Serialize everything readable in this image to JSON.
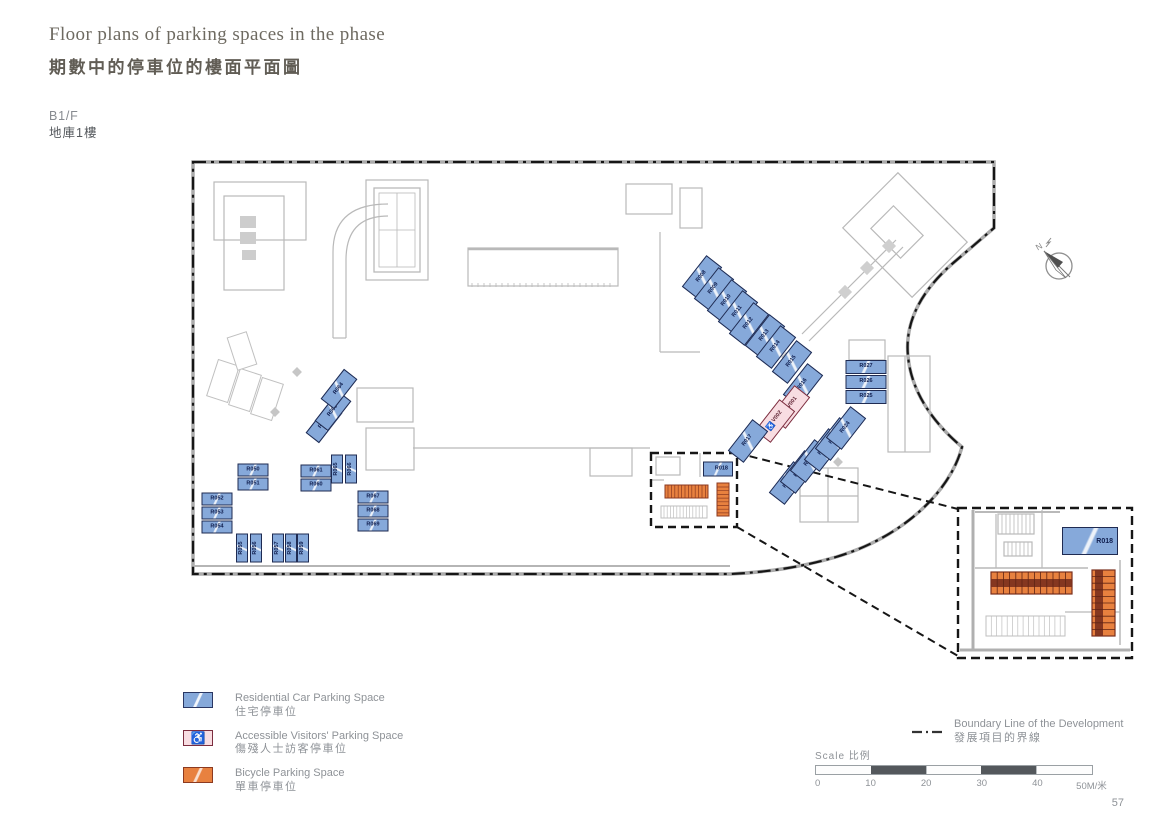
{
  "header": {
    "title_en": "Floor plans of parking spaces in the phase",
    "title_zh": "期數中的停車位的樓面平面圖",
    "floor_en": "B1/F",
    "floor_zh": "地庫1樓"
  },
  "compass": {
    "north_label": "N"
  },
  "legend": {
    "residential": {
      "label_en": "Residential Car Parking Space",
      "label_zh": "住宅停車位",
      "color": "#86a9da"
    },
    "accessible": {
      "label_en": "Accessible Visitors' Parking Space",
      "label_zh": "傷殘人士訪客停車位",
      "color": "#f8dde2",
      "icon": "wheelchair"
    },
    "bicycle": {
      "label_en": "Bicycle Parking Space",
      "label_zh": "單車停車位",
      "color": "#e8813f"
    },
    "boundary": {
      "label_en": "Boundary Line of the Development",
      "label_zh": "發展項目的界線"
    }
  },
  "scalebar": {
    "label": "Scale 比例",
    "ticks": [
      "0",
      "10",
      "20",
      "30",
      "40",
      "50M/米"
    ]
  },
  "page_number": "57",
  "colors": {
    "residential_fill": "#86a9da",
    "residential_border": "#1f2b52",
    "accessible_fill": "#f8dde2",
    "accessible_border": "#7c2d3f",
    "bicycle_fill": "#e8813f",
    "bicycle_border": "#8c3a20",
    "boundary_line": "#161616",
    "linework": "#b9b9b9"
  },
  "spaces": [
    {
      "label": "R008",
      "x": 702,
      "y": 277,
      "w": 40,
      "h": 20,
      "rot": -52
    },
    {
      "label": "R009",
      "x": 714,
      "y": 289,
      "w": 40,
      "h": 20,
      "rot": -52
    },
    {
      "label": "R010",
      "x": 727,
      "y": 301,
      "w": 40,
      "h": 20,
      "rot": -52
    },
    {
      "label": "R011",
      "x": 738,
      "y": 312,
      "w": 40,
      "h": 20,
      "rot": -52
    },
    {
      "label": "R012",
      "x": 749,
      "y": 324,
      "w": 40,
      "h": 20,
      "rot": -52
    },
    {
      "label": "R013",
      "x": 765,
      "y": 336,
      "w": 40,
      "h": 20,
      "rot": -52
    },
    {
      "label": "R014",
      "x": 776,
      "y": 347,
      "w": 40,
      "h": 20,
      "rot": -52
    },
    {
      "label": "R015",
      "x": 792,
      "y": 362,
      "w": 40,
      "h": 20,
      "rot": -52
    },
    {
      "label": "R016",
      "x": 803,
      "y": 385,
      "w": 40,
      "h": 20,
      "rot": -52
    },
    {
      "label": "V001",
      "x": 790,
      "y": 407,
      "w": 40,
      "h": 20,
      "rot": -52,
      "type": "a"
    },
    {
      "label": "V002",
      "x": 775,
      "y": 421,
      "w": 40,
      "h": 20,
      "rot": -52,
      "type": "a"
    },
    {
      "label": "R017",
      "x": 748,
      "y": 441,
      "w": 40,
      "h": 20,
      "rot": -52
    },
    {
      "label": "R019",
      "x": 789,
      "y": 483,
      "w": 40,
      "h": 20,
      "rot": -52
    },
    {
      "label": "R020",
      "x": 800,
      "y": 472,
      "w": 40,
      "h": 20,
      "rot": -52
    },
    {
      "label": "R021",
      "x": 810,
      "y": 461,
      "w": 40,
      "h": 20,
      "rot": -52
    },
    {
      "label": "R022",
      "x": 824,
      "y": 450,
      "w": 40,
      "h": 20,
      "rot": -52
    },
    {
      "label": "R023",
      "x": 835,
      "y": 439,
      "w": 40,
      "h": 20,
      "rot": -52
    },
    {
      "label": "R024",
      "x": 846,
      "y": 428,
      "w": 40,
      "h": 20,
      "rot": -52
    },
    {
      "label": "R025",
      "x": 866,
      "y": 397,
      "w": 41,
      "h": 14,
      "rot": 0
    },
    {
      "label": "R026",
      "x": 866,
      "y": 382,
      "w": 41,
      "h": 14,
      "rot": 0
    },
    {
      "label": "R027",
      "x": 866,
      "y": 367,
      "w": 41,
      "h": 14,
      "rot": 0
    },
    {
      "label": "R018",
      "x": 718,
      "y": 469,
      "w": 30,
      "h": 15,
      "rot": 0,
      "align": "right"
    },
    {
      "label": "R050",
      "x": 253,
      "y": 470,
      "w": 31,
      "h": 13,
      "rot": 0
    },
    {
      "label": "R051",
      "x": 253,
      "y": 484,
      "w": 31,
      "h": 13,
      "rot": 0
    },
    {
      "label": "R052",
      "x": 217,
      "y": 499,
      "w": 31,
      "h": 13,
      "rot": 0
    },
    {
      "label": "R053",
      "x": 217,
      "y": 513,
      "w": 31,
      "h": 13,
      "rot": 0
    },
    {
      "label": "R054",
      "x": 217,
      "y": 527,
      "w": 31,
      "h": 13,
      "rot": 0
    },
    {
      "label": "R055",
      "x": 242,
      "y": 548,
      "w": 29,
      "h": 12,
      "rot": -90
    },
    {
      "label": "R056",
      "x": 256,
      "y": 548,
      "w": 29,
      "h": 12,
      "rot": -90
    },
    {
      "label": "R057",
      "x": 278,
      "y": 548,
      "w": 29,
      "h": 12,
      "rot": -90
    },
    {
      "label": "R058",
      "x": 291,
      "y": 548,
      "w": 29,
      "h": 12,
      "rot": -90
    },
    {
      "label": "R059",
      "x": 303,
      "y": 548,
      "w": 29,
      "h": 12,
      "rot": -90
    },
    {
      "label": "R060",
      "x": 316,
      "y": 485,
      "w": 31,
      "h": 13,
      "rot": 0
    },
    {
      "label": "R061",
      "x": 316,
      "y": 471,
      "w": 31,
      "h": 13,
      "rot": 0
    },
    {
      "label": "R062",
      "x": 324,
      "y": 423,
      "w": 38,
      "h": 17,
      "rot": -52
    },
    {
      "label": "R063",
      "x": 333,
      "y": 411,
      "w": 38,
      "h": 17,
      "rot": -52
    },
    {
      "label": "R064",
      "x": 339,
      "y": 389,
      "w": 38,
      "h": 17,
      "rot": -52
    },
    {
      "label": "R065",
      "x": 337,
      "y": 469,
      "w": 29,
      "h": 12,
      "rot": -90
    },
    {
      "label": "R066",
      "x": 351,
      "y": 469,
      "w": 29,
      "h": 12,
      "rot": -90
    },
    {
      "label": "R067",
      "x": 373,
      "y": 497,
      "w": 31,
      "h": 13,
      "rot": 0
    },
    {
      "label": "R068",
      "x": 373,
      "y": 511,
      "w": 31,
      "h": 13,
      "rot": 0
    },
    {
      "label": "R069",
      "x": 373,
      "y": 525,
      "w": 31,
      "h": 13,
      "rot": 0
    },
    {
      "label": "R018",
      "x": 1090,
      "y": 541,
      "w": 56,
      "h": 28,
      "rot": 0,
      "fs": 7,
      "align": "right"
    }
  ]
}
